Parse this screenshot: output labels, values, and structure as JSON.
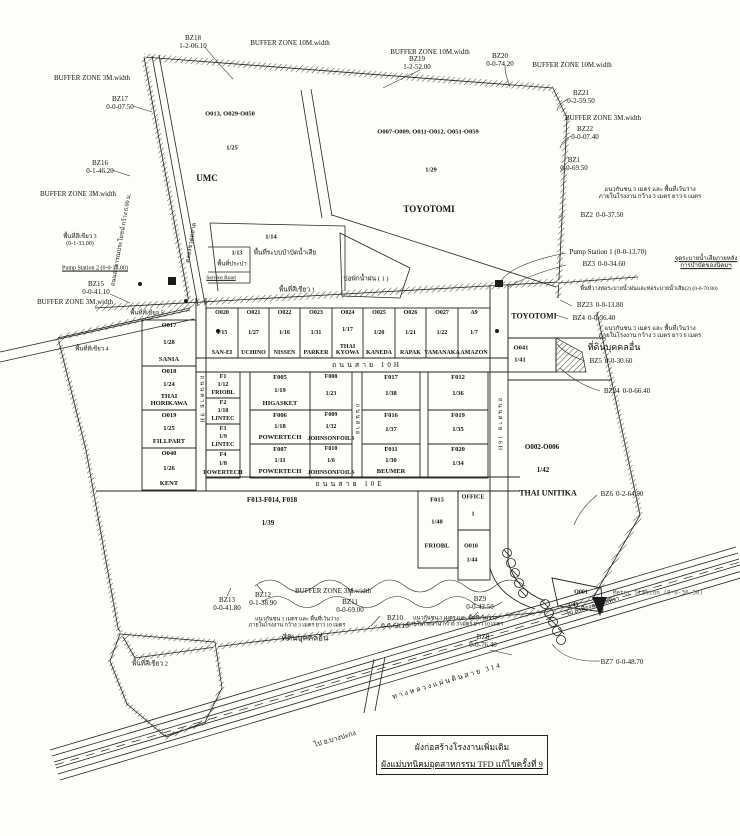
{
  "doc": {
    "title1": "ผังก่อสร้างโรงงานเพิ่มเติม",
    "title2": "ผังแม่บทนิคมอุตสาหกรรม TFD แก้ไขครั้งที่ 9"
  },
  "buffer": {
    "w10": "BUFFER ZONE 10M.width",
    "w3": "BUFFER ZONE 3M.width"
  },
  "bz": {
    "bz1": {
      "id": "BZ1",
      "area": "0-0-69.50"
    },
    "bz2": {
      "id": "BZ2",
      "area": "0-0-37.50"
    },
    "bz3": {
      "id": "BZ3",
      "area": "0-0-34.60"
    },
    "bz4": {
      "id": "BZ4",
      "area": "0-0-36.40"
    },
    "bz5": {
      "id": "BZ5",
      "area": "0-0-30.60"
    },
    "bz6": {
      "id": "BZ6",
      "area": "0-2-64.90"
    },
    "bz7": {
      "id": "BZ7",
      "area": "0-0-48.70"
    },
    "bz8": {
      "id": "BZ8",
      "area": "0-0-76.40"
    },
    "bz9": {
      "id": "BZ9",
      "area": "0-0-42.50"
    },
    "bz10": {
      "id": "BZ10",
      "area": "0-0-68.10"
    },
    "bz11": {
      "id": "BZ11",
      "area": "0-0-69.00"
    },
    "bz12": {
      "id": "BZ12",
      "area": "0-1-38.90"
    },
    "bz13": {
      "id": "BZ13",
      "area": "0-0-41.80"
    },
    "bz15": {
      "id": "BZ15",
      "area": "0-0-41.10"
    },
    "bz16": {
      "id": "BZ16",
      "area": "0-1-46.20"
    },
    "bz17": {
      "id": "BZ17",
      "area": "0-0-07.50"
    },
    "bz18": {
      "id": "BZ18",
      "area": "1-2-06.10"
    },
    "bz19": {
      "id": "BZ19",
      "area": "1-2-52.00"
    },
    "bz20": {
      "id": "BZ20",
      "area": "0-0-74.20"
    },
    "bz21": {
      "id": "BZ21",
      "area": "0-2-59.50"
    },
    "bz22": {
      "id": "BZ22",
      "area": "0-0-07.40"
    },
    "bz23": {
      "id": "BZ23",
      "area": "0-0-13.80"
    },
    "bz24": {
      "id": "BZ24",
      "area": "0-0-66.40"
    }
  },
  "stations": {
    "pump1": "Pump Station 1 (0-0-13.70)",
    "pump2": "Pump Station 2 (0-0-15.00)",
    "meter": "Meter Station (0-0-36.30)"
  },
  "roads": {
    "highway": "ทางหลวงแผ่นดินสาย 314",
    "to_left": "ไป อ.บางปะกง",
    "to_right": "ไป อ.เมืองฉะเชิงเทรา",
    "h1": "ถนนสาย 10H",
    "h2": "ถนนสาย 10E",
    "v1": "ถนนสาย 9H",
    "v2": "ถนนสาย",
    "v4": "ถนนสาย 16H",
    "public": "ถนนสาธารณประโยชน์ กว้าง 6.00 ม.",
    "canal": "คลองชวดตลาด",
    "service": "Service Road"
  },
  "areas": {
    "green1": "พื้นที่สีเขียว 1",
    "green2": "พื้นที่สีเขียว 2",
    "green3": "พื้นที่สีเขียว 3",
    "green3_area": "(0-1-33.00)",
    "green4": "พื้นที่สีเขียว 4",
    "green5": "พื้นที่สีเขียว 5",
    "others_land": "ที่ดินบุคคลอื่น",
    "pond1": "บ่อพักน้ำฝน ( 1 )",
    "wwt": "พื้นที่ระบบบำบัดน้ำเสีย",
    "wwt_no": "1/14",
    "water": "พื้นที่ประปา",
    "water_no": "1/13"
  },
  "notes": {
    "setback1": "แนวกันชน 3 เมตร และ พื้นที่เว้นว่าง",
    "setback6": "ภายในโรงงาน กว้าง 3 เมตร ยาว 6 เมตร",
    "setback10": "ภายในโรงงาน กว้าง 3 เมตร ยาว 10 เมตร",
    "drain1": "จุดระบายน้ำเสียภายหลัง",
    "drain2": "การบำบัดของนิคมฯ",
    "pipe2": "พื้นที่วางท่อระบายน้ำฝนและท่อระบายน้ำเสีย(2) (0-0-70.80)"
  },
  "plots": {
    "row1": [
      {
        "code": "O020",
        "no": "1/15",
        "name": "SAN-EI"
      },
      {
        "code": "O021",
        "no": "1/27",
        "name": "UCHINO"
      },
      {
        "code": "O022",
        "no": "1/16",
        "name": "NISSEN"
      },
      {
        "code": "O023",
        "no": "1/31",
        "name": "PARKER"
      },
      {
        "code": "O024",
        "no": "1/17",
        "name": "THAI KYOWA"
      },
      {
        "code": "O025",
        "no": "1/20",
        "name": "KANEDA"
      },
      {
        "code": "O026",
        "no": "1/21",
        "name": "RAPAK"
      },
      {
        "code": "O027",
        "no": "1/22",
        "name": "YAMANAKA"
      },
      {
        "code": "A9",
        "no": "1/7",
        "name": "AMAZON"
      }
    ],
    "west": [
      {
        "code": "O017",
        "no": "1/28",
        "name": "SANIA"
      },
      {
        "code": "O018",
        "no": "1/24",
        "name": "THAI HORIKAWA"
      },
      {
        "code": "O019",
        "no": "1/25",
        "name": "FILLPART"
      },
      {
        "code": "O040",
        "no": "1/26",
        "name": "KENT"
      }
    ],
    "fcol": [
      {
        "code": "F1",
        "no": "1/12",
        "name": "FRIOBL"
      },
      {
        "code": "F2",
        "no": "1/10",
        "name": "LINTEC"
      },
      {
        "code": "F3",
        "no": "1/9",
        "name": "LINTEC"
      },
      {
        "code": "F4",
        "no": "1/8",
        "name": "POWERTECH"
      }
    ],
    "fgrid": [
      {
        "code": "F005",
        "no": "1/19",
        "name": "HIGASKET"
      },
      {
        "code": "F008",
        "no": "1/23",
        "name": ""
      },
      {
        "code": "F017",
        "no": "1/38",
        "name": ""
      },
      {
        "code": "F012",
        "no": "1/36",
        "name": ""
      },
      {
        "code": "F006",
        "no": "1/18",
        "name": "POWERTECH"
      },
      {
        "code": "F009",
        "no": "1/32",
        "name": "JOHNSONFOILS"
      },
      {
        "code": "F016",
        "no": "1/37",
        "name": ""
      },
      {
        "code": "F019",
        "no": "1/35",
        "name": ""
      },
      {
        "code": "F007",
        "no": "1/11",
        "name": "POWERTECH"
      },
      {
        "code": "F010",
        "no": "1/6",
        "name": "JOHNSONFOILS"
      },
      {
        "code": "F011",
        "no": "1/30",
        "name": "BEUMER"
      },
      {
        "code": "F020",
        "no": "1/34",
        "name": ""
      }
    ],
    "umc": {
      "codes": "O013, O029-O050",
      "no": "1/25",
      "name": "UMC"
    },
    "toyo_n": {
      "codes": "O007-O009, O011-O012, O051-O059",
      "no": "1/29",
      "name": "TOYOTOMI"
    },
    "toyo_e": {
      "name": "TOYOTOMI"
    },
    "o041": {
      "code": "O041",
      "no": "1/41"
    },
    "unitika": {
      "codes": "O002-O006",
      "no": "1/42",
      "name": "THAI UNITIKA"
    },
    "f013": {
      "codes": "F013-F014, F018",
      "no": "1/39"
    },
    "f015": {
      "code": "F015",
      "no": "1/40",
      "name": "FRIOBL"
    },
    "office": {
      "name": "OFFICE",
      "no": "1"
    },
    "o010": {
      "code": "O010",
      "no": "1/44"
    },
    "o001": {
      "code": "O001",
      "no": "1/45"
    }
  }
}
